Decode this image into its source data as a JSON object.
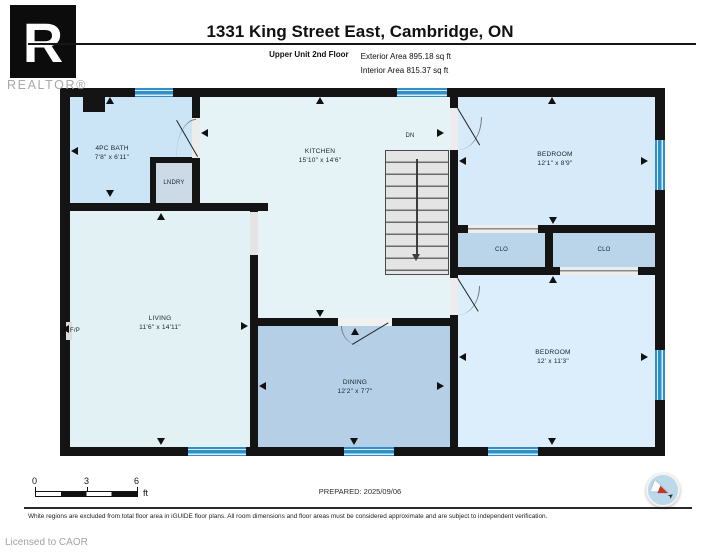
{
  "header": {
    "logo_letter": "R",
    "logo_word": "REALTOR®",
    "title": "1331 King Street East, Cambridge, ON",
    "floor_label": "Upper Unit 2nd Floor",
    "exterior_area": "Exterior Area 895.18 sq ft",
    "interior_area": "Interior Area 815.37 sq ft"
  },
  "plan": {
    "rooms": {
      "bath": {
        "name": "4PC BATH",
        "dims": "7'8\" x 6'11\""
      },
      "laundry": {
        "name": "LNDRY"
      },
      "kitchen": {
        "name": "KITCHEN",
        "dims": "15'10\" x 14'6\""
      },
      "bedroom_top": {
        "name": "BEDROOM",
        "dims": "12'1\" x 8'9\""
      },
      "closet_left": {
        "name": "CLO"
      },
      "closet_right": {
        "name": "CLO"
      },
      "living": {
        "name": "LIVING",
        "dims": "11'6\" x 14'11\""
      },
      "dining": {
        "name": "DINING",
        "dims": "12'2\" x 7'7\""
      },
      "bedroom_bottom": {
        "name": "BEDROOM",
        "dims": "12' x 11'3\""
      },
      "fireplace": "F/P",
      "stairs": "DN"
    }
  },
  "scale_bar": {
    "ticks": [
      "0",
      "3",
      "6"
    ],
    "unit": "ft"
  },
  "prepared": "PREPARED: 2025/09/06",
  "disclaimer": "White regions are excluded from total floor area in iGUIDE floor plans. All room dimensions and floor areas must be considered approximate and are subject to independent verification.",
  "license": "Licensed to CAOR",
  "colors": {
    "wall": "#141414",
    "window": "#2f8fc6",
    "room_pale": "#e6f3f6",
    "room_blue": "#cbe4f6",
    "room_medium": "#b4cfe6",
    "compass_red": "#c63327"
  }
}
